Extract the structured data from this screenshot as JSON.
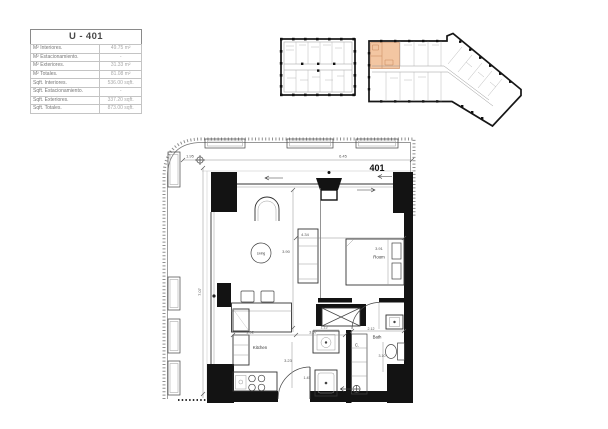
{
  "info_table": {
    "title": "U - 401",
    "rows": [
      {
        "label": "M² Interiores.",
        "value": "49.75 m²"
      },
      {
        "label": "M² Estacionamiento.",
        "value": "-"
      },
      {
        "label": "M² Exteriores.",
        "value": "31.33 m²"
      },
      {
        "label": "M² Totales.",
        "value": "81.08 m²"
      },
      {
        "label": "Sqft. Interiores.",
        "value": "536.00 sqft."
      },
      {
        "label": "Sqft. Estacionamiento.",
        "value": "-"
      },
      {
        "label": "Sqft. Exteriores.",
        "value": "337.20 sqft."
      },
      {
        "label": "Sqft. Totales.",
        "value": "873.00 sqft."
      }
    ]
  },
  "key_plans": {
    "highlight_color": "#f3c6a2",
    "highlight_line_color": "#c8885a"
  },
  "floor_plan": {
    "unit_number": "401",
    "room_labels": {
      "living": "Living",
      "room": "Room",
      "kitchen": "Kitchen",
      "bath": "Bath",
      "closet": "C."
    },
    "dimensions": {
      "balcony_width": "1.95",
      "top_overall": "6.45",
      "left_overall": "7.07",
      "living_depth": "3.90",
      "living_width": "4.34",
      "room_width": "3.91",
      "kitchen_width": "1.92",
      "hall_width": "3.07",
      "entry_width": "1.13",
      "bath_width": "2.12",
      "kitchen_depth": "3.23",
      "bath_depth": "3.10",
      "shower_width": "1.45"
    }
  }
}
